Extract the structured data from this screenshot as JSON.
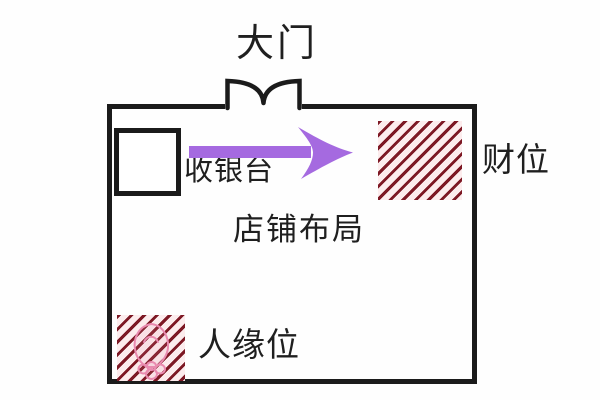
{
  "diagram": {
    "title": "店铺布局",
    "door": {
      "label": "大门"
    },
    "cashier": {
      "label": "收银台"
    },
    "wealth_corner": {
      "label": "财位"
    },
    "popularity_corner": {
      "label": "人缘位"
    },
    "colors": {
      "background": "#fefefe",
      "wall": "#1b1b1b",
      "text": "#1f1f1f",
      "arrow": "#a56ae0",
      "hatch_stripe": "#7d1824",
      "hatch_bg": "#fceced",
      "flower": "#e98bb0"
    }
  }
}
